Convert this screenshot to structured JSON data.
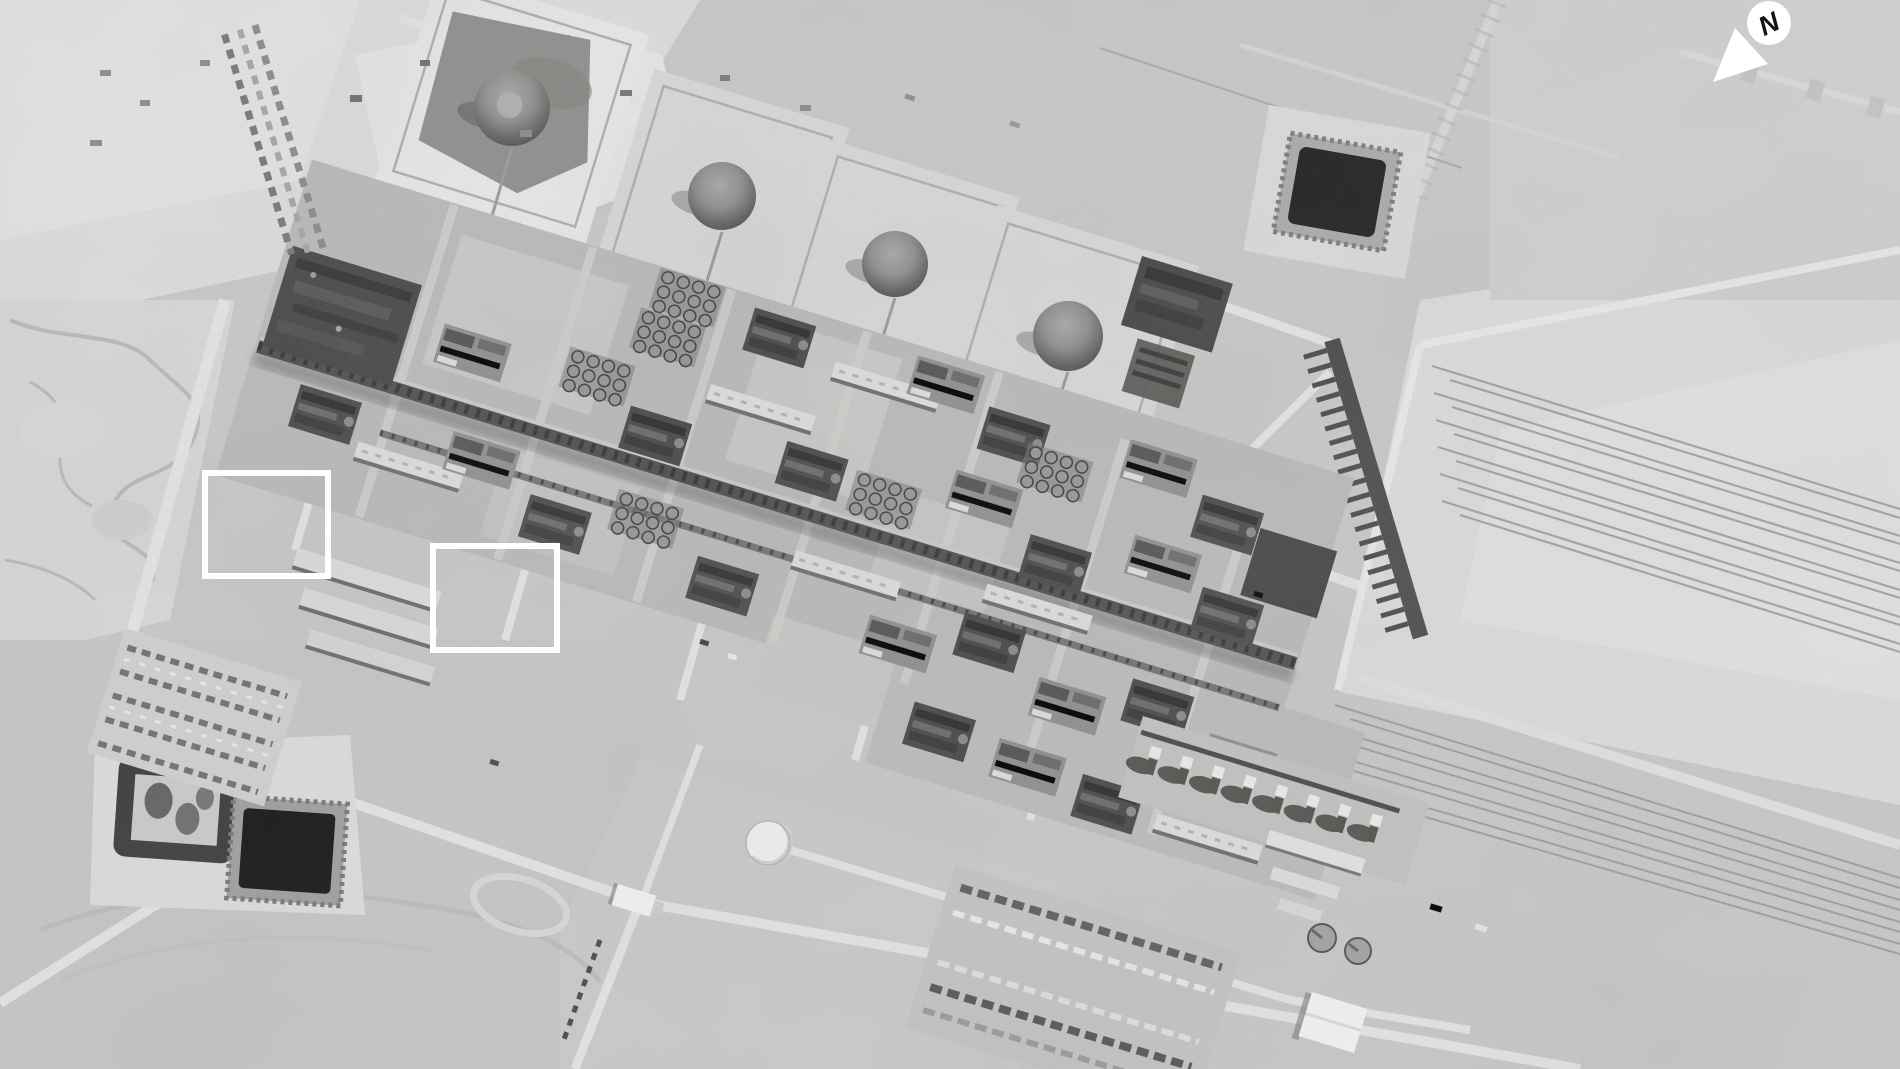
{
  "scene": {
    "description": "Black-and-white overhead satellite photograph of a large oil processing facility in flat desert terrain: four dome-roof storage tanks on bermed diamond pads across the top, a dense diagonal band of processing trains and pipe racks through the center, a near-black square evaporation pond at upper right, two dark ponds at lower left, a pipeline corridor of thin parallel lines on the right, laydown/container yards and a gate complex at the bottom.",
    "storage_dome_count": 4,
    "evaporation_pond_count": 3,
    "highlight_box_count": 2
  },
  "compass": {
    "label": "N"
  },
  "annotations": {
    "highlight_boxes": [
      {
        "name": "highlight-box-west",
        "purpose": "marks damaged processing unit"
      },
      {
        "name": "highlight-box-center",
        "purpose": "marks damaged processing unit"
      }
    ]
  },
  "palette": {
    "desert": "#c7c6c4",
    "desert_bright": "#e2e1df",
    "plant_ground": "#b9b8b6",
    "plant_dark": "#454443",
    "pond_dark": "#1b1b19",
    "annotation_white": "#ffffff"
  }
}
